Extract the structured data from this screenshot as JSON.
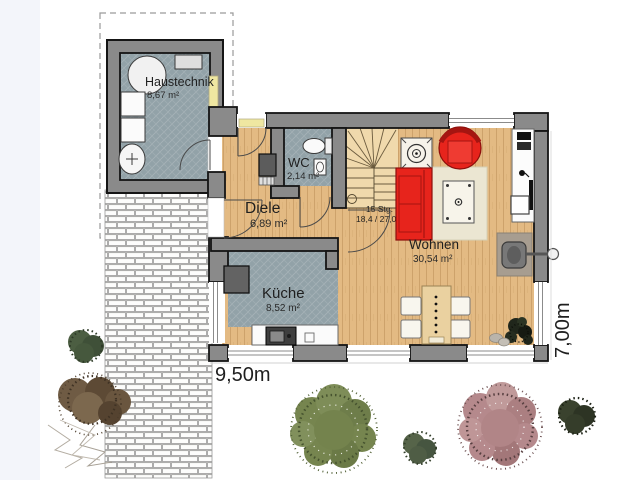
{
  "plan": {
    "rooms": {
      "haustechnik": {
        "name": "Haustechnik",
        "area": "8,67 m²"
      },
      "wc": {
        "name": "WC",
        "area": "2,14 m²"
      },
      "diele": {
        "name": "Diele",
        "area": "6,89 m²"
      },
      "kueche": {
        "name": "Küche",
        "area": "8,52 m²"
      },
      "wohnen": {
        "name": "Wohnen",
        "area": "30,54 m²"
      }
    },
    "stairs": {
      "steps": "15 Stg.",
      "dims": "18,4 / 27,0"
    },
    "dimensions": {
      "width": "9,50m",
      "depth": "7,00m"
    }
  },
  "colors": {
    "wall": "#8a8a8a",
    "wood_floor": "#e3ba83",
    "tile_floor": "#92a2a8",
    "accent_red": "#e7241c",
    "stair_floor": "#f0d9ac",
    "rug": "#ebe6d2",
    "side_strip": "#f3f5fa"
  }
}
